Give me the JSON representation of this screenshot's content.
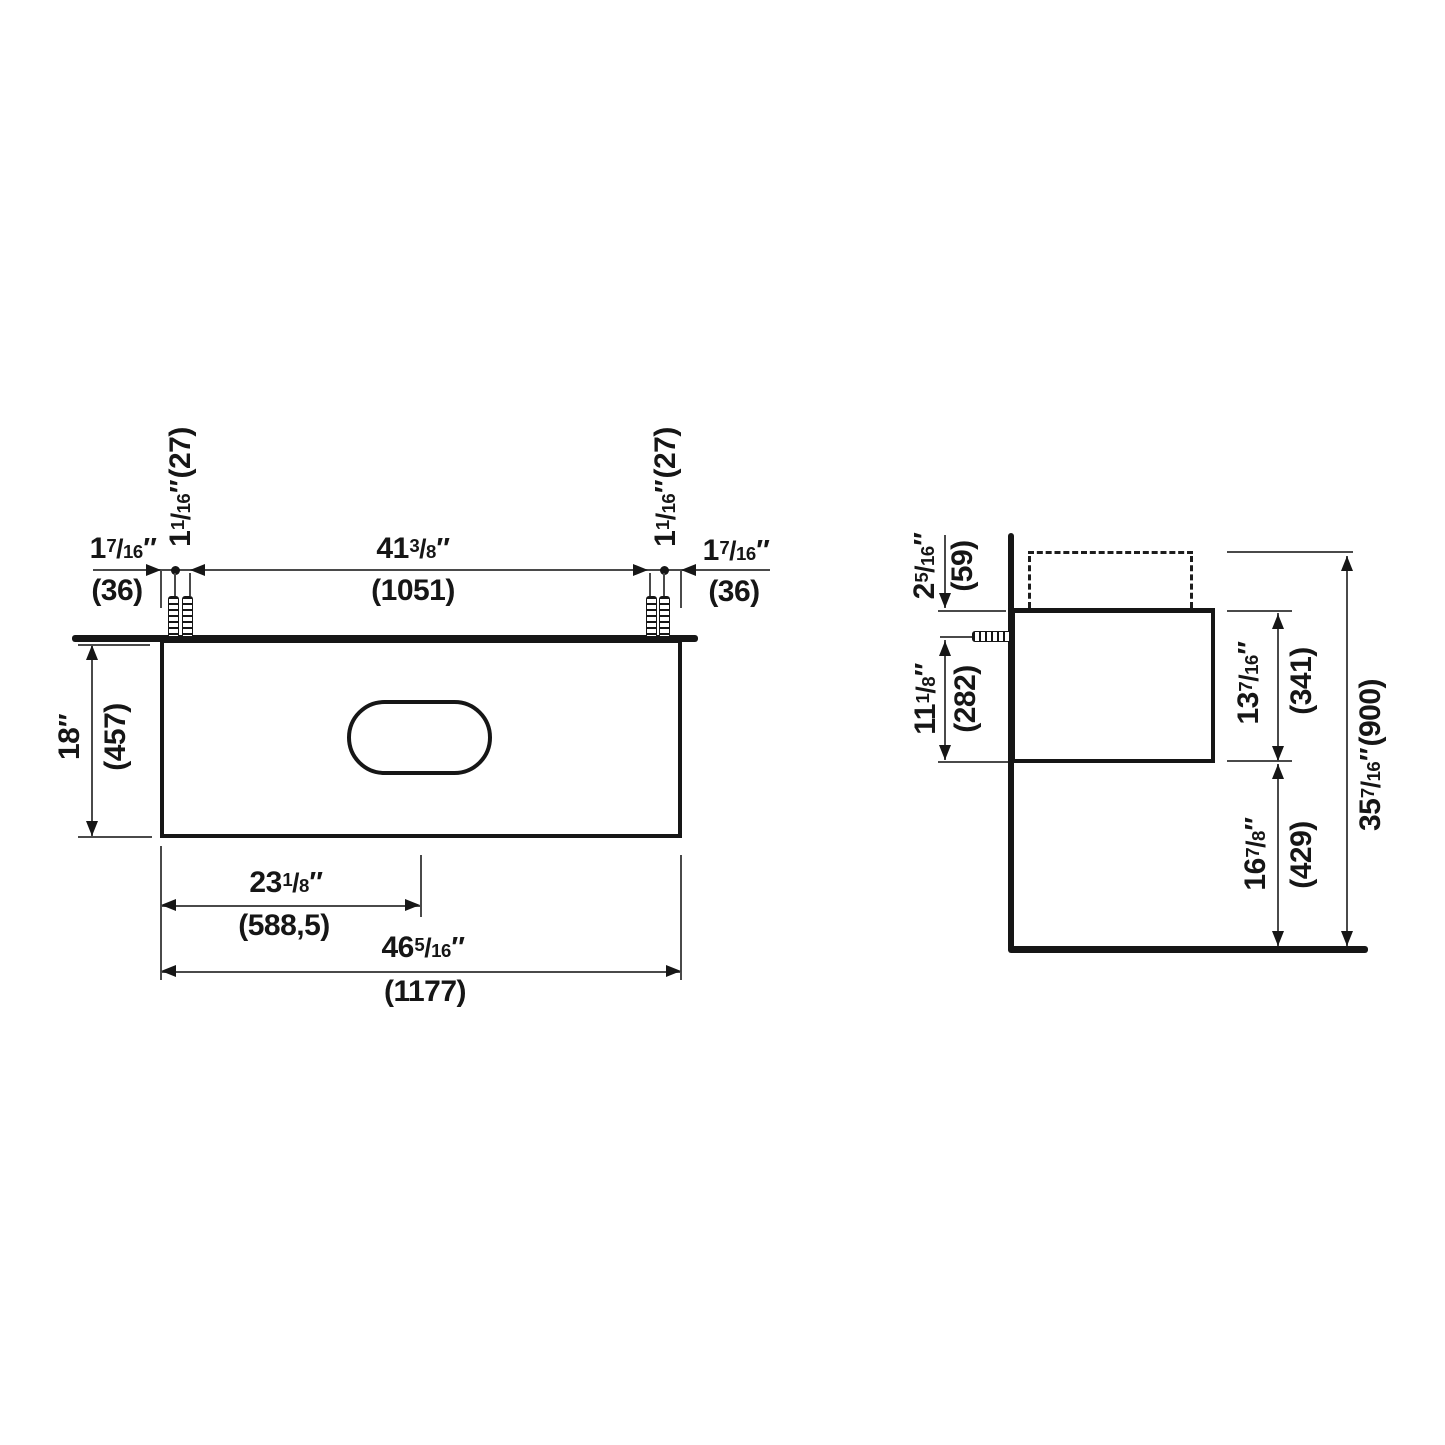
{
  "diagram": {
    "type": "technical-dimension-drawing",
    "subject": "wall-mounted vanity cabinet with countertop and basin cutout",
    "colors": {
      "line": "#161616",
      "hairline": "#4a4a4a",
      "background": "#ffffff"
    },
    "front": {
      "dims": {
        "edge_offset": {
          "w": "1",
          "n": "7",
          "d": "16",
          "q": "″",
          "m": "(36)"
        },
        "screw_spacing": {
          "w": "1",
          "n": "1",
          "d": "16",
          "q": "″",
          "tail": "(27)"
        },
        "screw_span": {
          "w": "41",
          "n": "3",
          "d": "8",
          "q": "″",
          "m": "(1051)"
        },
        "depth": {
          "w": "18",
          "q": "″",
          "m": "(457)"
        },
        "center_offset": {
          "w": "23",
          "n": "1",
          "d": "8",
          "q": "″",
          "m": "(588,5)"
        },
        "width": {
          "w": "46",
          "n": "5",
          "d": "16",
          "q": "″",
          "m": "(1177)"
        }
      }
    },
    "side": {
      "dims": {
        "rim_to_cabinet_top": {
          "w": "2",
          "n": "5",
          "d": "16",
          "q": "″",
          "m": "(59)"
        },
        "anchor_to_bottom": {
          "w": "11",
          "n": "1",
          "d": "8",
          "q": "″",
          "m": "(282)"
        },
        "cabinet_height": {
          "w": "13",
          "n": "7",
          "d": "16",
          "q": "″",
          "m": "(341)"
        },
        "bottom_clearance": {
          "w": "16",
          "n": "7",
          "d": "8",
          "q": "″",
          "m": "(429)"
        },
        "total_height": {
          "w": "35",
          "n": "7",
          "d": "16",
          "q": "″",
          "tail": "(900)"
        }
      }
    }
  }
}
